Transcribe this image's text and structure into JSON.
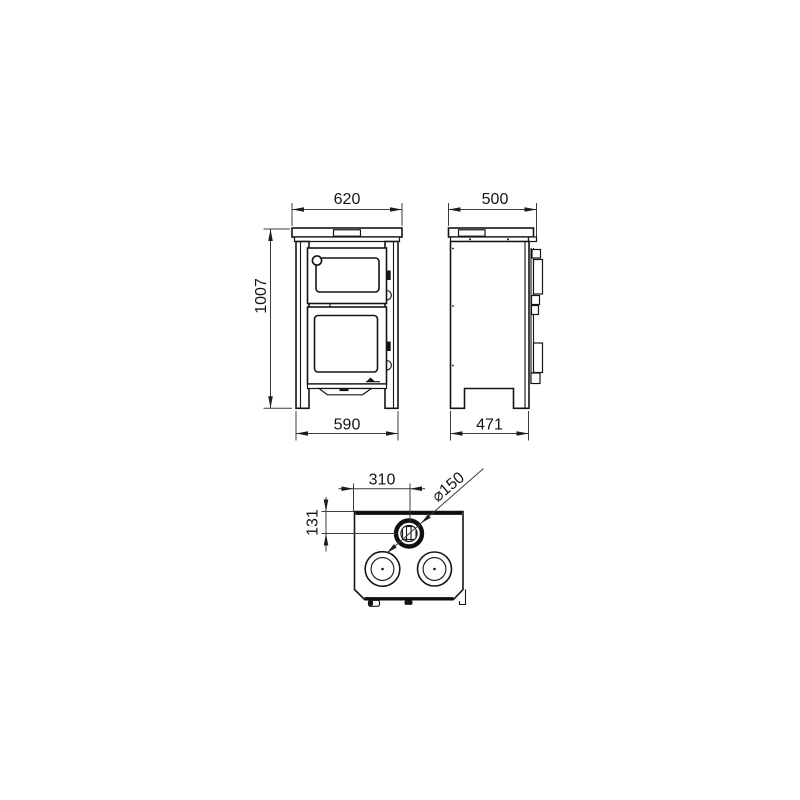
{
  "drawing": {
    "kind": "stove-technical-dimension-drawing",
    "views": [
      "front",
      "side",
      "top"
    ]
  },
  "dims": {
    "front_width": "620",
    "depth": "500",
    "overall_height": "1007",
    "front_leg_span": "590",
    "side_leg_span": "471",
    "flue_center_from_left": "310",
    "flue_center_from_back": "131",
    "flue_diameter": "⌀150"
  }
}
